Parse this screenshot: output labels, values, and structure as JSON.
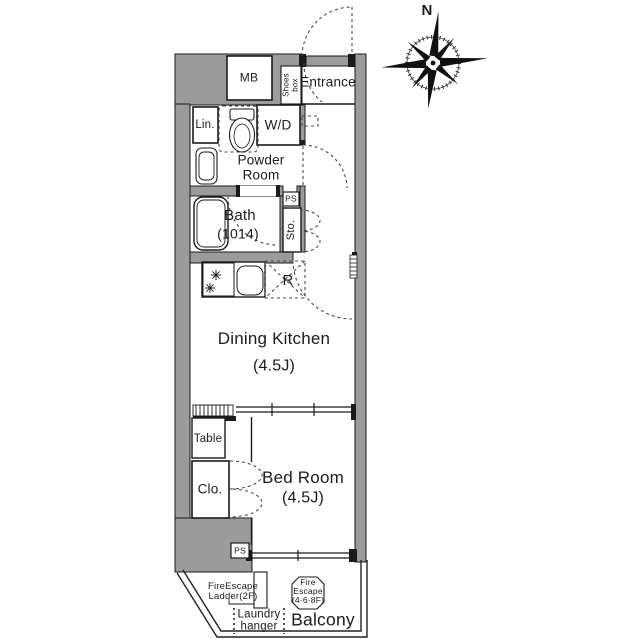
{
  "plan": {
    "compass_north": "N",
    "entrance": {
      "label": "Entrance",
      "mb": "MB",
      "shoes_box": [
        "Shoes",
        "box"
      ]
    },
    "powder_room": {
      "label": [
        "Powder",
        "Room"
      ],
      "linen": "Lin.",
      "washer_dryer": "W/D"
    },
    "bath": {
      "label": "Bath",
      "size": "(1014)"
    },
    "storage": {
      "ps_upper": "PS",
      "sto": "Sto.",
      "ps_lower": "PS"
    },
    "kitchen": {
      "label": "Dining Kitchen",
      "size": "(4.5J)",
      "refrigerator": "R"
    },
    "bedroom": {
      "label": "Bed Room",
      "size": "(4.5J)",
      "table": "Table",
      "closet": "Clo."
    },
    "balcony": {
      "label": "Balcony",
      "fire_escape_ladder": [
        "FireEscape",
        "Ladder(2F)"
      ],
      "laundry_hanger": [
        "Laundry",
        "hanger"
      ],
      "fire_escape_hatch": [
        "Fire",
        "Escape",
        "(4·6·8F)"
      ]
    }
  },
  "colors": {
    "wall": "#9b9b9b",
    "line": "#1a1a1a",
    "dash": "#4a4a4a"
  }
}
